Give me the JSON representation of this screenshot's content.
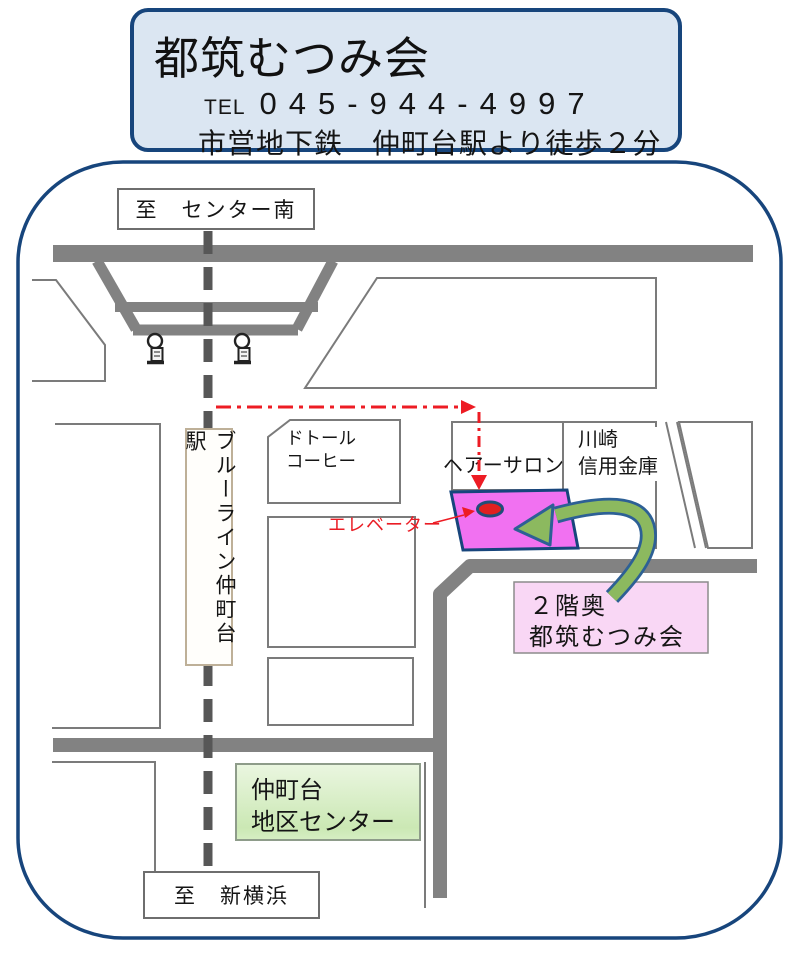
{
  "header": {
    "title": "都筑むつみ会",
    "tel_label": "TEL",
    "tel_number": "045-944-4997",
    "access": "市営地下鉄　仲町台駅より徒歩２分"
  },
  "map": {
    "to_north": "至　センター南",
    "to_south": "至　新横浜",
    "station_line": "ブルーライン仲町台駅",
    "labels": {
      "doutor_line1": "ドトール",
      "doutor_line2": "コーヒー",
      "hair_salon": "ヘアーサロン",
      "kawasaki_line1": "川崎",
      "kawasaki_line2": "信用金庫",
      "elevator": "エレベーター"
    },
    "district_center": {
      "line1": "仲町台",
      "line2": "地区センター"
    },
    "destination": {
      "line1": "２階奥",
      "line2": "都筑むつみ会"
    }
  },
  "colors": {
    "accent_blue": "#17457c",
    "header_bg": "#dbe6f2",
    "road_gray": "#828282",
    "rail_gray": "#575757",
    "building_outline": "#7b7b7b",
    "route_red": "#ed1c24",
    "site_pink": "#f171f1",
    "marker_red": "#e02020",
    "arrow_green": "#8cb95f",
    "arrow_outline": "#2d6095",
    "destination_box_bg": "#f9d7f5",
    "district_center_bg": "#cbe8b4"
  }
}
